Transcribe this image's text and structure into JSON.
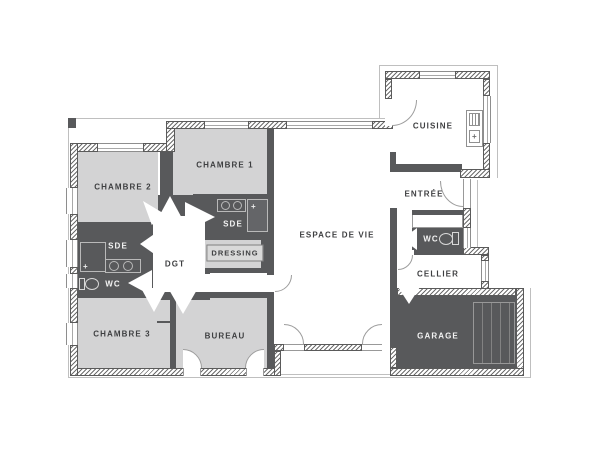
{
  "plan": {
    "type": "house-floor-plan",
    "colors": {
      "wall_dark": "#58595b",
      "room_light_fill": "#d3d3d4",
      "room_dark_fill": "#58595b",
      "background": "#ffffff",
      "label_dark": "#3e3f41",
      "label_light": "#f3f3f3",
      "outline": "#bfbfbf"
    },
    "rooms": {
      "chambre1": {
        "label": "CHAMBRE 1"
      },
      "chambre2": {
        "label": "CHAMBRE 2"
      },
      "chambre3": {
        "label": "CHAMBRE 3"
      },
      "sde_left": {
        "label": "SDE"
      },
      "sde_mid": {
        "label": "SDE"
      },
      "wc_left": {
        "label": "WC"
      },
      "wc_right": {
        "label": "WC"
      },
      "dressing": {
        "label": "DRESSING"
      },
      "dgt": {
        "label": "DGT"
      },
      "bureau": {
        "label": "BUREAU"
      },
      "espace_de_vie": {
        "label": "ESPACE DE VIE"
      },
      "cuisine": {
        "label": "CUISINE"
      },
      "entree": {
        "label": "ENTRÉE"
      },
      "cellier": {
        "label": "CELLIER"
      },
      "garage": {
        "label": "GARAGE"
      }
    }
  }
}
